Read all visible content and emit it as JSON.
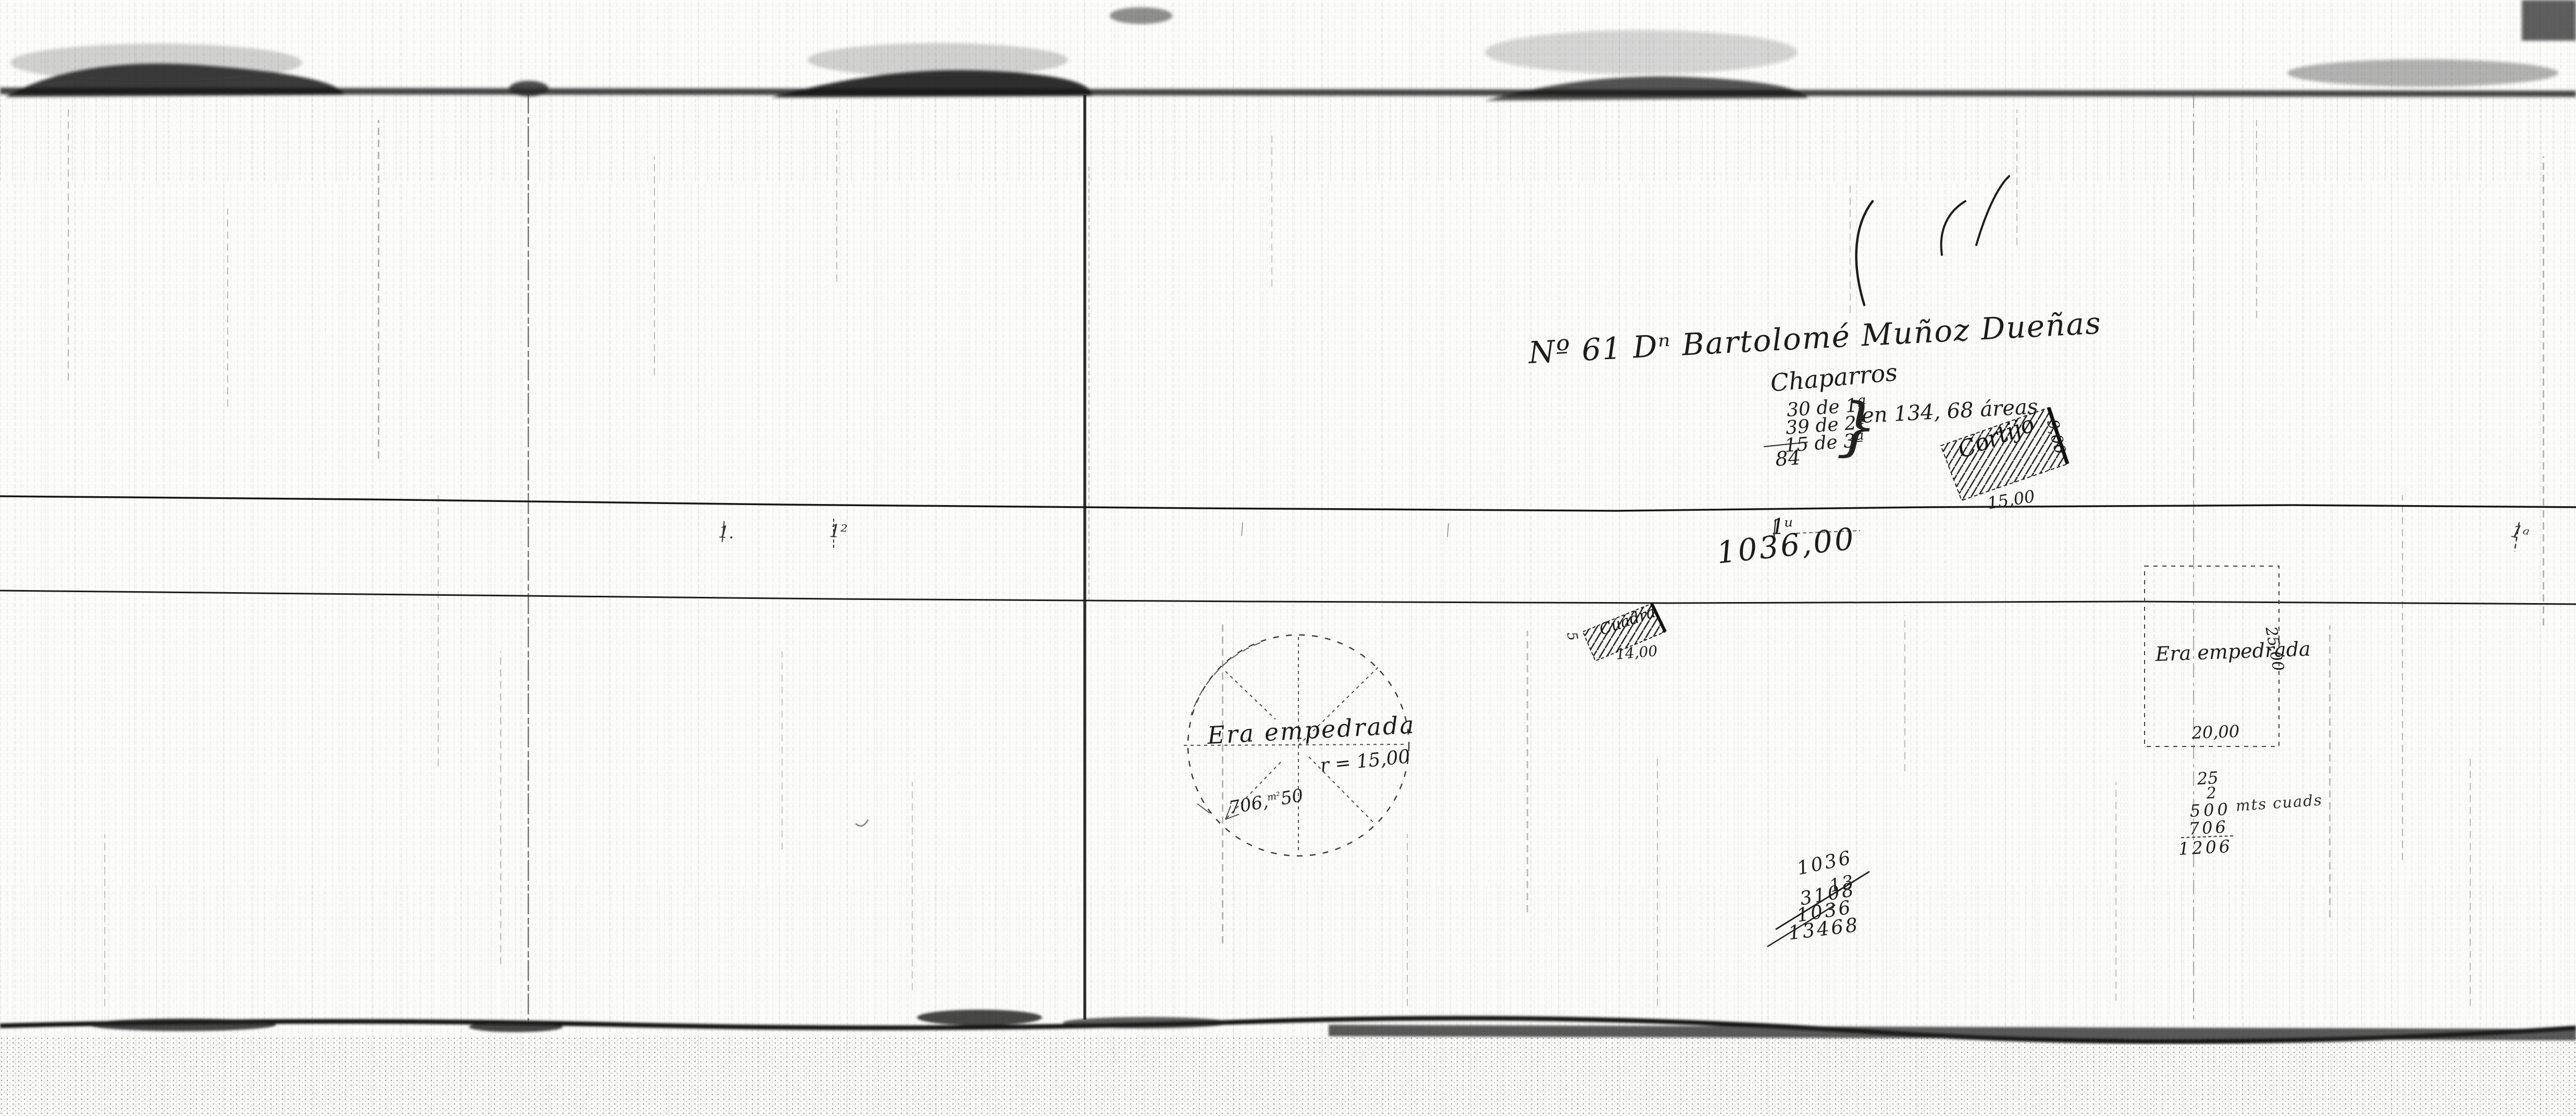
{
  "header": {
    "title": "Nº 61 Dⁿ Bartolomé Muñoz Dueñas"
  },
  "chaparros": {
    "heading": "Chaparros",
    "rows": [
      "30 de 1ª",
      "39 de 2ª",
      "15 de 3ª"
    ],
    "brace": "}",
    "total": "84",
    "area_note": "en 134, 68 áreas"
  },
  "road": {
    "length": "1036,00",
    "ticks": [
      "1.",
      "1²",
      "1ᵘ",
      "1ᵃ"
    ]
  },
  "cortijo": {
    "name": "Cortijo",
    "front": "15,00",
    "side": "9,00"
  },
  "cuadra": {
    "name": "Cuadra",
    "front": "14,00",
    "side": "5"
  },
  "era_circle": {
    "name": "Era empedrada",
    "radius": "r = 15,00",
    "area_main": "706,",
    "area_sup": "m²",
    "area_rest": "50"
  },
  "era_square": {
    "name": "Era empedrada",
    "width": "20,00",
    "side": "25,00"
  },
  "calc_area": {
    "lines": [
      "25",
      "2",
      "500",
      "706",
      "1206"
    ],
    "unit": "mts cuads"
  },
  "calc_total": {
    "lines": [
      "1036",
      "13",
      "3108",
      "1036",
      "13468"
    ]
  }
}
